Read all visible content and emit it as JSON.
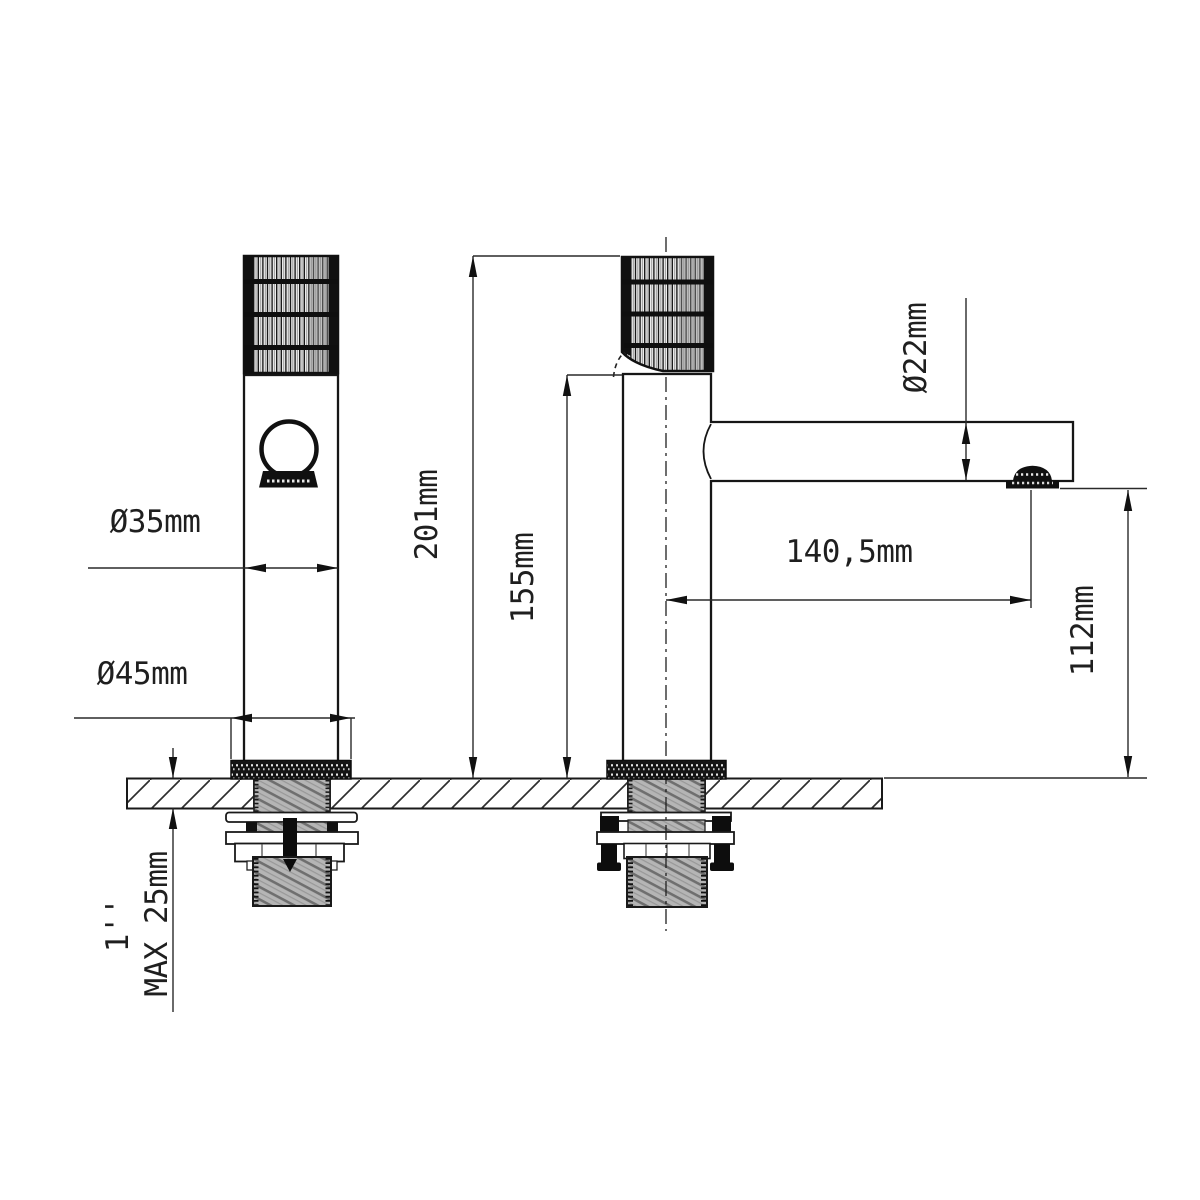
{
  "drawing": {
    "background": "#ffffff",
    "ink": "#1b1b1b",
    "labels": {
      "body_diameter": "Ø35mm",
      "base_diameter": "Ø45mm",
      "total_height": "201mm",
      "body_height": "155mm",
      "spout_diameter": "Ø22mm",
      "spout_reach": "140,5mm",
      "outlet_height": "112mm",
      "max_deck_thickness": "MAX 25mm",
      "connection_thread": "1''"
    }
  }
}
